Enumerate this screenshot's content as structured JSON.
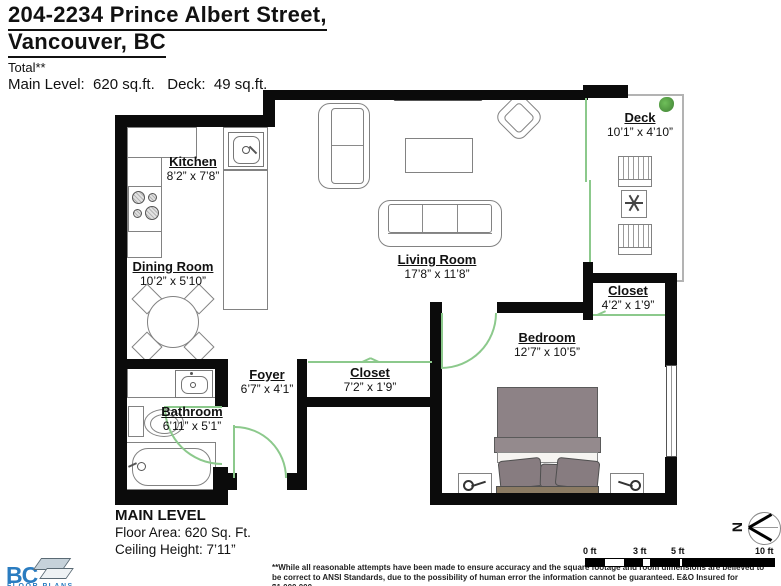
{
  "header": {
    "address_line1": "204-2234 Prince Albert Street,",
    "address_line2": "Vancouver, BC",
    "total_label": "Total**",
    "area_summary": "Main Level:  620 sq.ft.   Deck:  49 sq.ft."
  },
  "rooms": {
    "kitchen": {
      "name": "Kitchen",
      "dims": "8’2” x 7’8”"
    },
    "dining_room": {
      "name": "Dining Room",
      "dims": "10’2” x 5’10”"
    },
    "living_room": {
      "name": "Living Room",
      "dims": "17’8” x 11’8”"
    },
    "deck": {
      "name": "Deck",
      "dims": "10’1” x 4’10”"
    },
    "bedroom": {
      "name": "Bedroom",
      "dims": "12’7” x 10’5”"
    },
    "bedroom_closet": {
      "name": "Closet",
      "dims": "4’2” x 1’9”"
    },
    "hall_closet": {
      "name": "Closet",
      "dims": "7’2” x 1’9”"
    },
    "foyer": {
      "name": "Foyer",
      "dims": "6’7” x 4’1”"
    },
    "bathroom": {
      "name": "Bathroom",
      "dims": "6’11” x 5’1”"
    }
  },
  "footer": {
    "level_title": "MAIN LEVEL",
    "floor_area": "Floor Area: 620 Sq. Ft.",
    "ceiling_height": "Ceiling Height: 7’11”",
    "disclaimer_line1": "**While all reasonable attempts have been made to ensure accuracy and the square footage and room dimensions are believed to",
    "disclaimer_line2": "be correct to ANSI Standards, due to the possibility of human error the information cannot be guaranteed. E&O Insured for $1,000,000"
  },
  "scale_bar": {
    "labels": [
      "0 ft",
      "3 ft",
      "5 ft",
      "10 ft"
    ]
  },
  "compass": {
    "north_label": "N"
  },
  "logo": {
    "name": "BC",
    "subtitle": "FLOOR PLANS"
  },
  "colors": {
    "wall": "#0b0b0b",
    "door_green": "#8cc98c",
    "logo_blue": "#2a7cc0",
    "bed_duvet": "#8d8286",
    "bed_pillow": "#877c80",
    "headboard_tan": "#8b7b63",
    "tv_dark": "#3d3d3d"
  }
}
